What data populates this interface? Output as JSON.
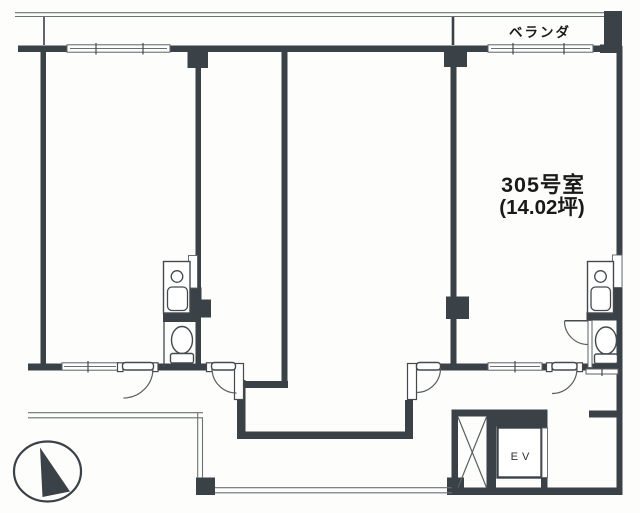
{
  "page": {
    "type": "floor-plan-drawing"
  },
  "labels": {
    "balcony": "ベランダ",
    "room_number": "305号室",
    "room_area": "(14.02坪)",
    "elevator": "EV"
  },
  "colors": {
    "wall": "#3a4147",
    "thin_line": "#6b7075",
    "text": "#1a1a1a",
    "background": "#ffffff"
  }
}
